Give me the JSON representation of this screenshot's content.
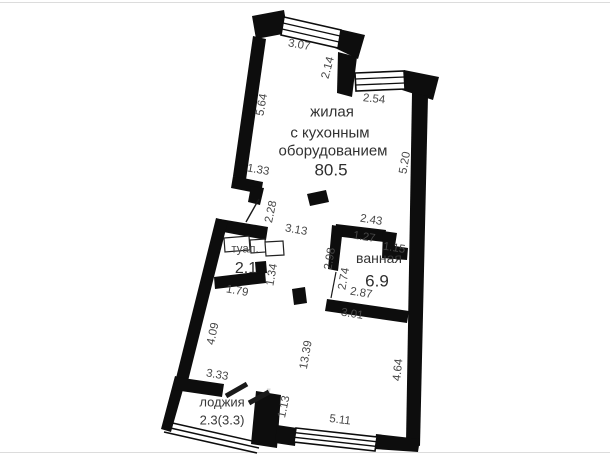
{
  "floor_plan": {
    "main_room": {
      "name_line1": "жилая",
      "name_line2": "с кухонным",
      "name_line3": "оборудованием",
      "area": "80.5"
    },
    "bathroom": {
      "name": "ванная",
      "area": "6.9"
    },
    "toilet": {
      "name": "туал.",
      "area": "2.1"
    },
    "loggia": {
      "name": "лоджия",
      "area": "2.3(3.3)"
    },
    "dims": {
      "d307": "3.07",
      "d214": "2.14",
      "d254": "2.54",
      "d564": "5.64",
      "d520": "5.20",
      "d133": "1.33",
      "d228": "2.28",
      "d313": "3.13",
      "d243": "2.43",
      "d127": "1.27",
      "d115": "1.15",
      "d298": "2.98",
      "d274": "2.74",
      "d287": "2.87",
      "d301": "3.01",
      "d134": "1.34",
      "d179": "1.79",
      "d409": "4.09",
      "d1339": "13.39",
      "d464": "4.64",
      "d333": "3.33",
      "d113": "1.13",
      "d511": "5.11"
    },
    "colors": {
      "wall": "#0d0d0d",
      "dim_text": "#474747",
      "room_text": "#323232"
    }
  },
  "watermark": "t"
}
